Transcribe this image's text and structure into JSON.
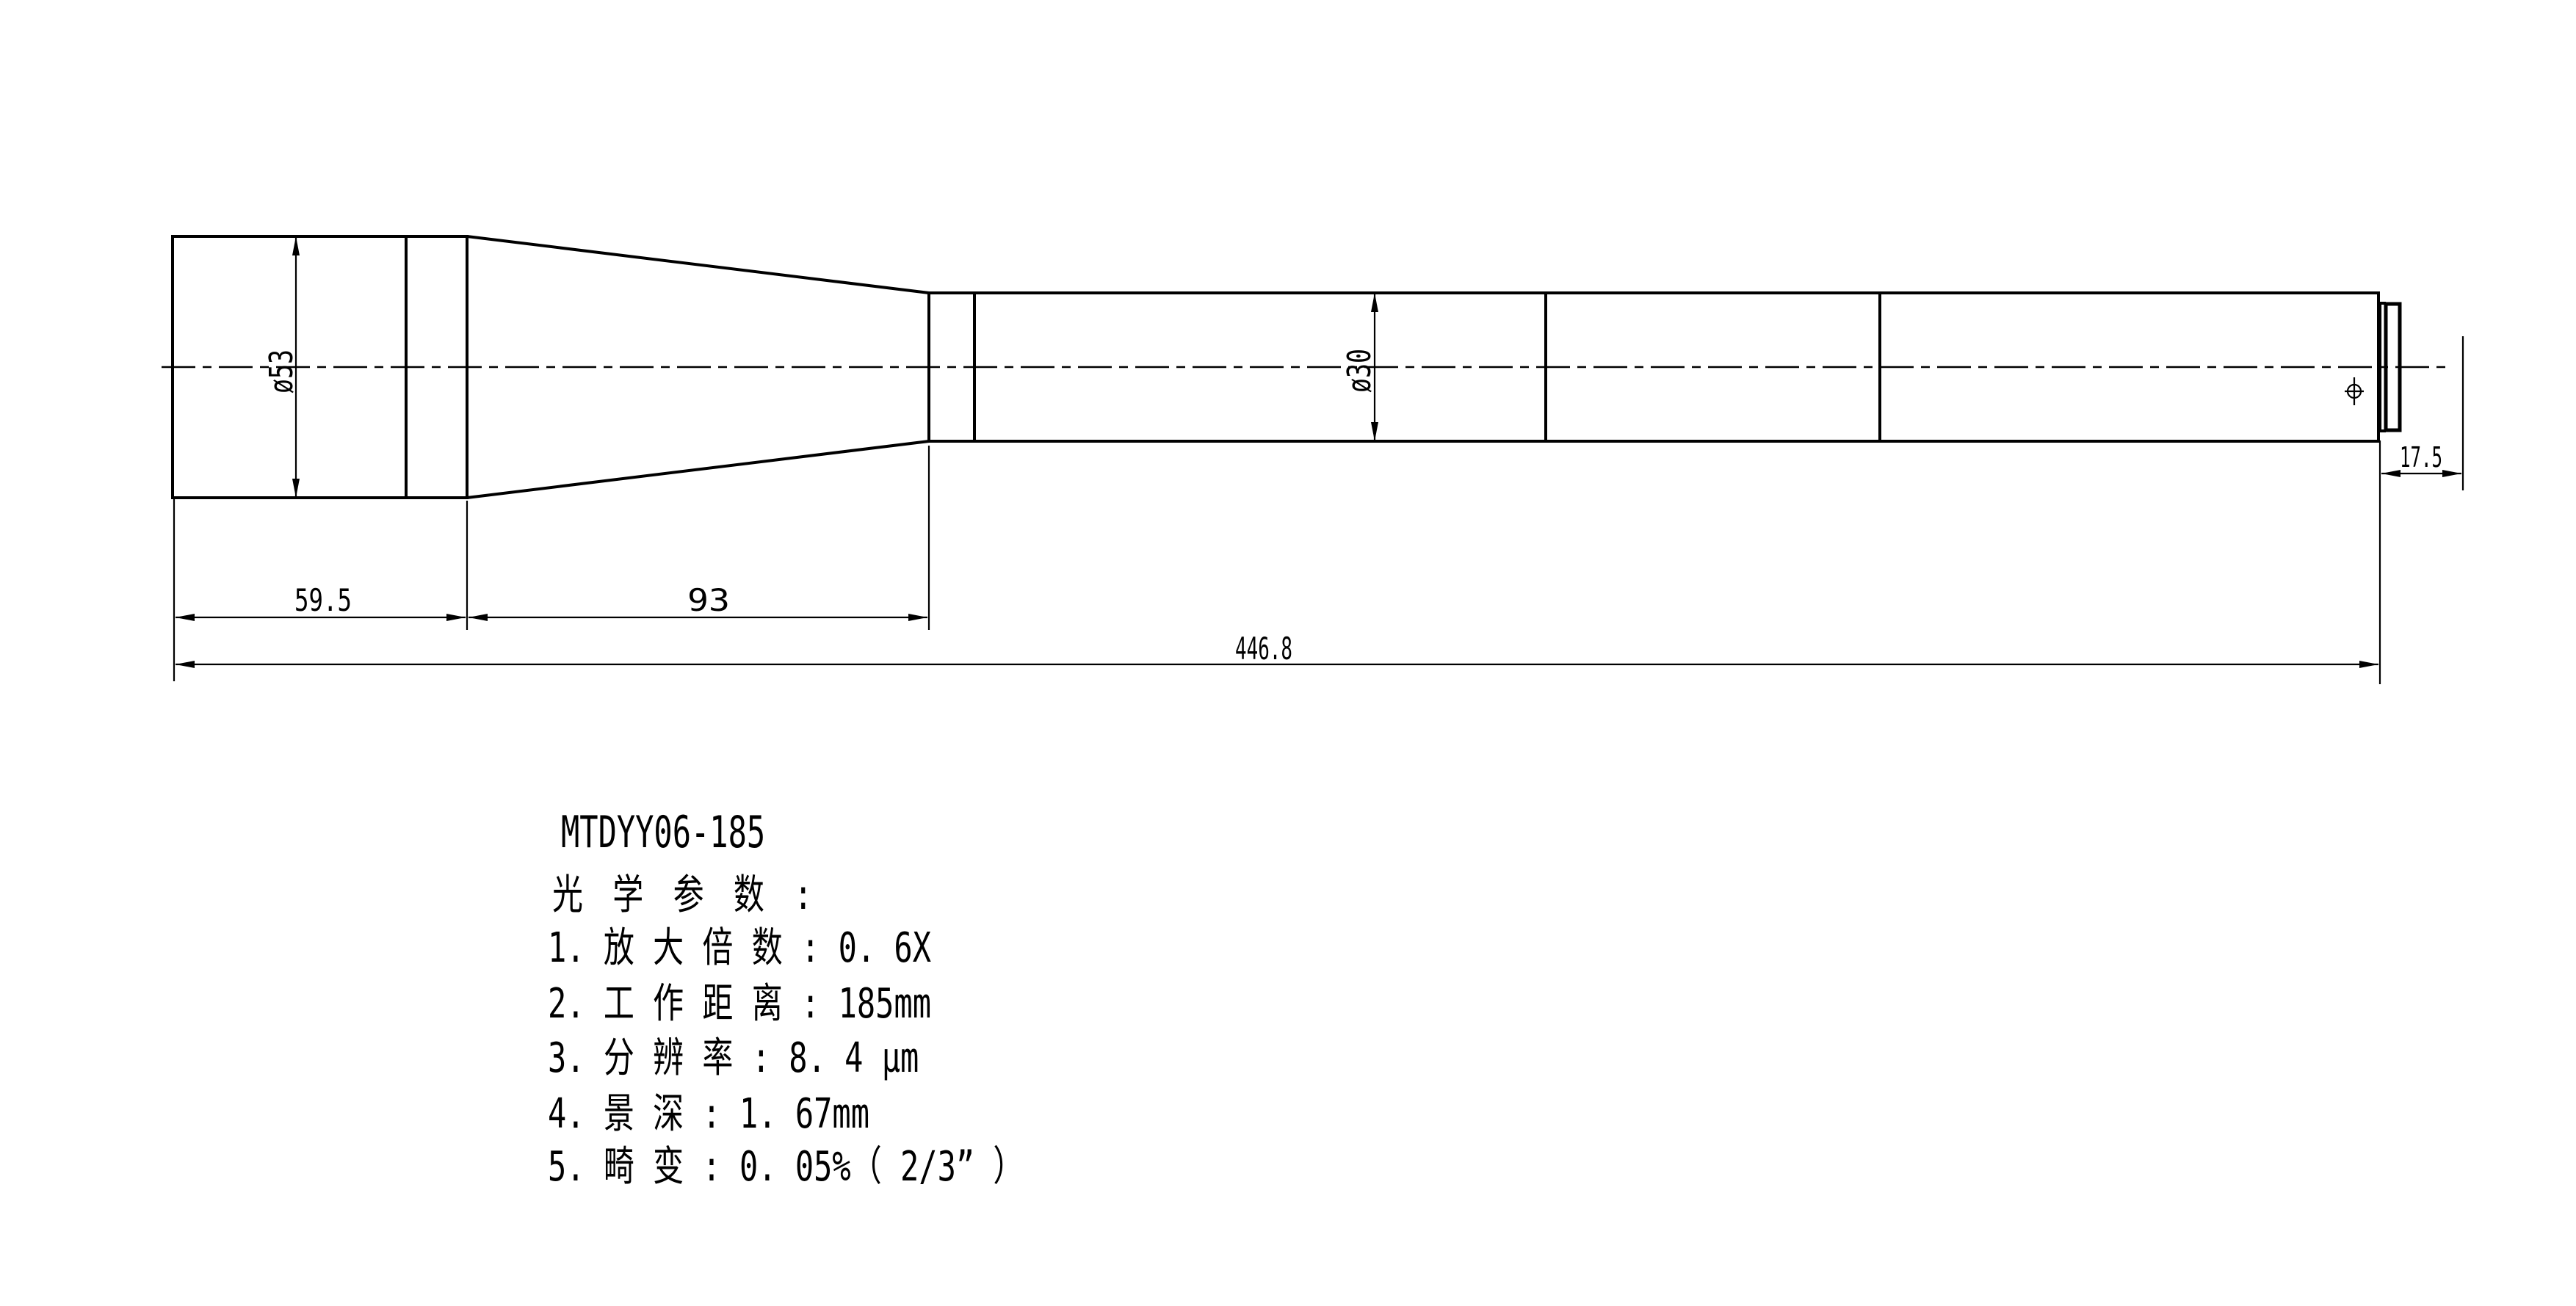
{
  "page": {
    "background": "#ffffff",
    "line_color": "#000000"
  },
  "drawing": {
    "part_number": "MTDYY06-185",
    "section_heading": "光 学 参 数 :",
    "specs": [
      "1. 放 大 倍 数 : 0. 6X",
      "2. 工 作 距 离 : 185mm",
      "3. 分 辨 率 : 8. 4 μm",
      "4. 景 深 : 1. 67mm",
      "5. 畸 变 : 0. 05%（ 2/3” ）"
    ],
    "dimensions": {
      "front_diameter": "ø53",
      "tube_diameter": "ø30",
      "front_length": "59.5",
      "cone_length": "93",
      "overall_length": "446.8",
      "rear_flange_offset": "17.5"
    }
  }
}
